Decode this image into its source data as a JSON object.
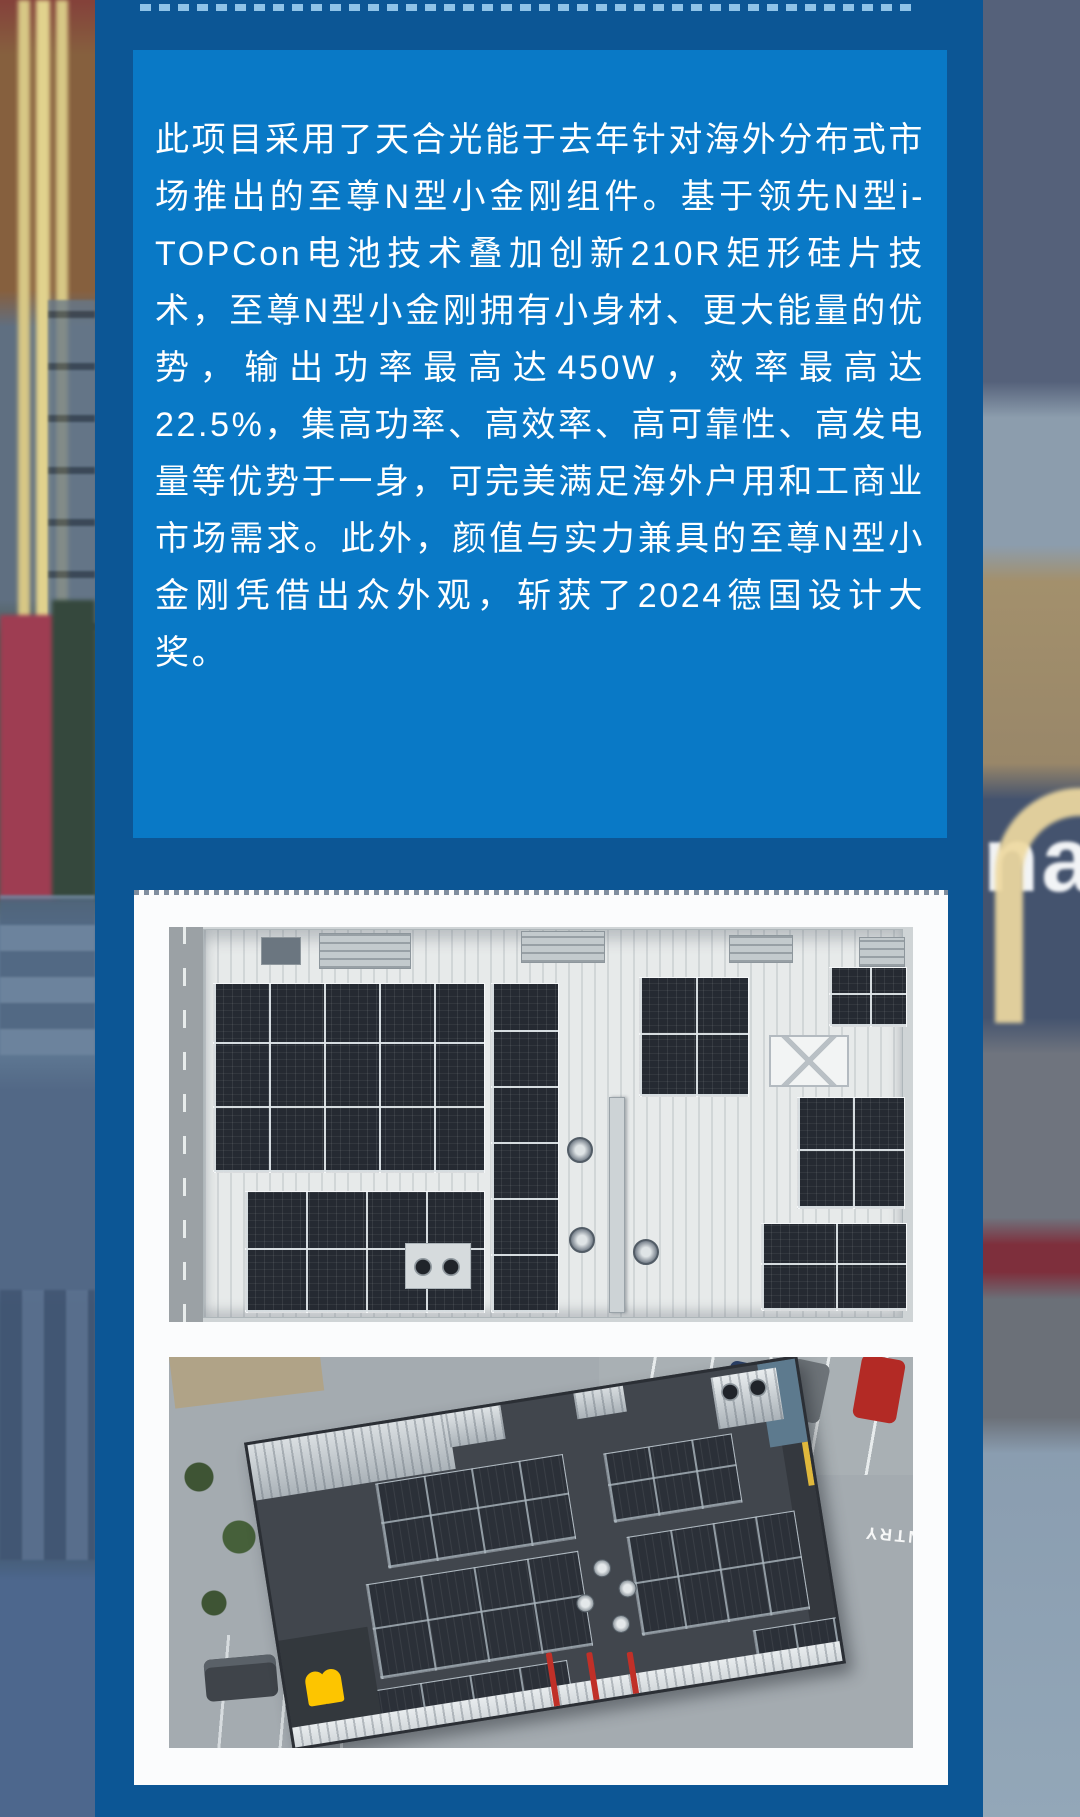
{
  "theme": {
    "outer_blue": "#0C5695",
    "card_blue": "#0979C6",
    "dash_color": "#8FC3E8",
    "text_color": "#FFFFFF",
    "panel_white": "#FBFCFD",
    "mcdonalds_yellow": "#FDC500"
  },
  "article": {
    "body": "此项目采用了天合光能于去年针对海外分布式市场推出的至尊N型小金刚组件。基于领先N型i-TOPCon电池技术叠加创新210R矩形硅片技术，至尊N型小金刚拥有小身材、更大能量的优势，输出功率最高达450W，效率最高达22.5%，集高功率、高效率、高可靠性、高发电量等优势于一身，可完美满足海外户用和工商业市场需求。此外，颜值与实力兼具的至尊N型小金刚凭借出众外观，斩获了2024德国设计大奖。"
  },
  "background": {
    "right_sign_fragment": "na"
  },
  "photos": {
    "photo1": "rooftop-solar-array-top-down-aerial",
    "photo2": "mcdonalds-restaurant-rooftop-solar-aerial",
    "road_marking": "ENTRY"
  }
}
